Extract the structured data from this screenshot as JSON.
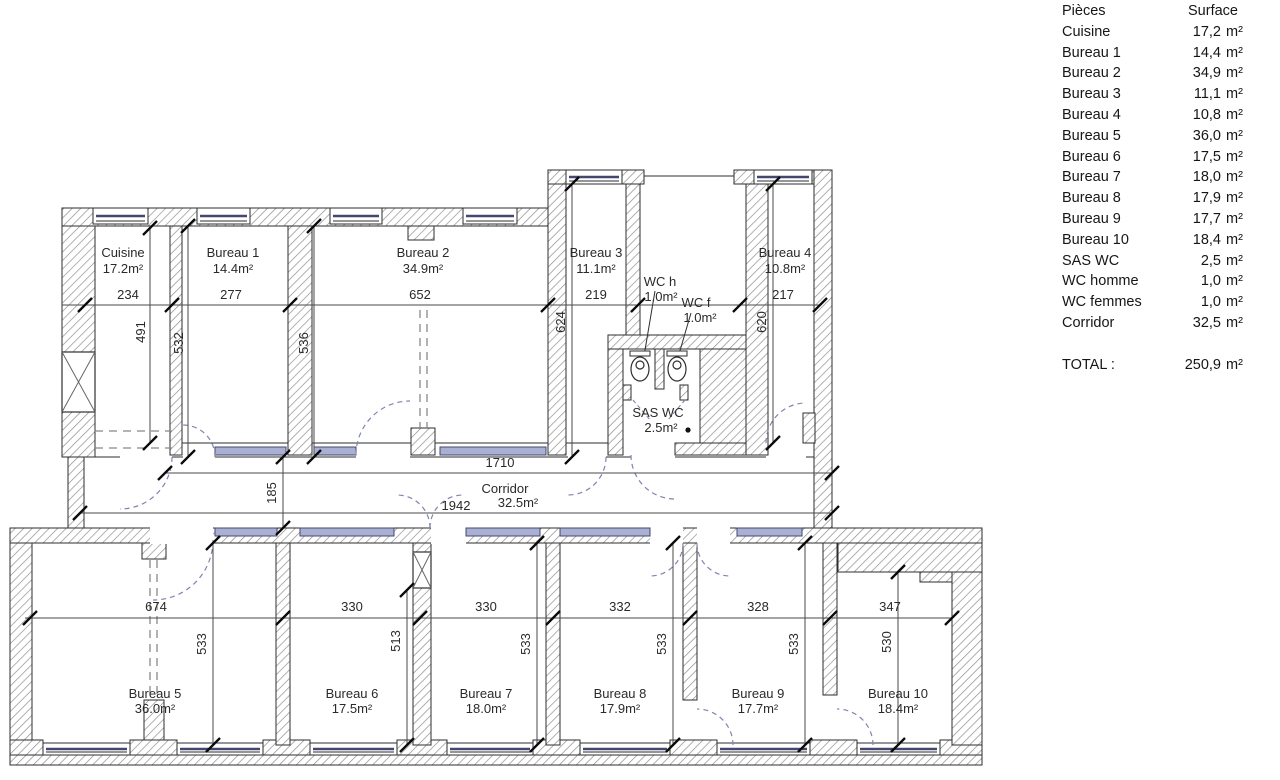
{
  "table": {
    "header": {
      "pieces": "Pièces",
      "surface": "Surface"
    },
    "rows": [
      {
        "name": "Cuisine",
        "value": "17,2",
        "unit": "m²"
      },
      {
        "name": "Bureau 1",
        "value": "14,4",
        "unit": "m²"
      },
      {
        "name": "Bureau 2",
        "value": "34,9",
        "unit": "m²"
      },
      {
        "name": "Bureau 3",
        "value": "11,1",
        "unit": "m²"
      },
      {
        "name": "Bureau 4",
        "value": "10,8",
        "unit": "m²"
      },
      {
        "name": "Bureau 5",
        "value": "36,0",
        "unit": "m²"
      },
      {
        "name": "Bureau 6",
        "value": "17,5",
        "unit": "m²"
      },
      {
        "name": "Bureau 7",
        "value": "18,0",
        "unit": "m²"
      },
      {
        "name": "Bureau 8",
        "value": "17,9",
        "unit": "m²"
      },
      {
        "name": "Bureau 9",
        "value": "17,7",
        "unit": "m²"
      },
      {
        "name": "Bureau 10",
        "value": "18,4",
        "unit": "m²"
      },
      {
        "name": "SAS WC",
        "value": "2,5",
        "unit": "m²"
      },
      {
        "name": "WC homme",
        "value": "1,0",
        "unit": "m²"
      },
      {
        "name": "WC femmes",
        "value": "1,0",
        "unit": "m²"
      },
      {
        "name": "Corridor",
        "value": "32,5",
        "unit": "m²"
      }
    ],
    "total": {
      "label": "TOTAL :",
      "value": "250,9",
      "unit": "m²"
    }
  },
  "plan": {
    "top_rooms": [
      {
        "name": "Cuisine",
        "area": "17.2m²",
        "width": "234"
      },
      {
        "name": "Bureau 1",
        "area": "14.4m²",
        "width": "277"
      },
      {
        "name": "Bureau 2",
        "area": "34.9m²",
        "width": "652"
      },
      {
        "name": "Bureau 3",
        "area": "11.1m²",
        "width": "219"
      },
      {
        "name": "Bureau 4",
        "area": "10.8m²",
        "width": "217"
      }
    ],
    "top_heights": [
      "491",
      "532",
      "536",
      "624",
      "620"
    ],
    "wc": {
      "wc_h_name": "WC h",
      "wc_h_area": "1.0m²",
      "wc_f_name": "WC f",
      "wc_f_area": "1.0m²",
      "sas_name": "SAS WC",
      "sas_area": "2.5m²"
    },
    "corridor": {
      "name": "Corridor",
      "area": "32.5m²",
      "dim_top": "1710",
      "dim_width": "185",
      "dim_bottom": "1942"
    },
    "bottom_rooms": [
      {
        "name": "Bureau 5",
        "area": "36.0m²",
        "width": "674",
        "height": "533"
      },
      {
        "name": "Bureau 6",
        "area": "17.5m²",
        "width": "330",
        "height": "513"
      },
      {
        "name": "Bureau 7",
        "area": "18.0m²",
        "width": "330",
        "height": "533"
      },
      {
        "name": "Bureau 8",
        "area": "17.9m²",
        "width": "332",
        "height": "533"
      },
      {
        "name": "Bureau 9",
        "area": "17.7m²",
        "width": "328",
        "height": "533"
      },
      {
        "name": "Bureau 10",
        "area": "18.4m²",
        "width": "347",
        "height": "530"
      }
    ]
  },
  "colors": {
    "wall_line": "#2e2e2e",
    "hatch": "#8f8f8f",
    "glazing_fill": "#aab0d4",
    "glazing_line": "#44486e",
    "door_arc": "#8084b0",
    "dim_line": "#4a4a4a",
    "text": "#2a2a2a"
  }
}
